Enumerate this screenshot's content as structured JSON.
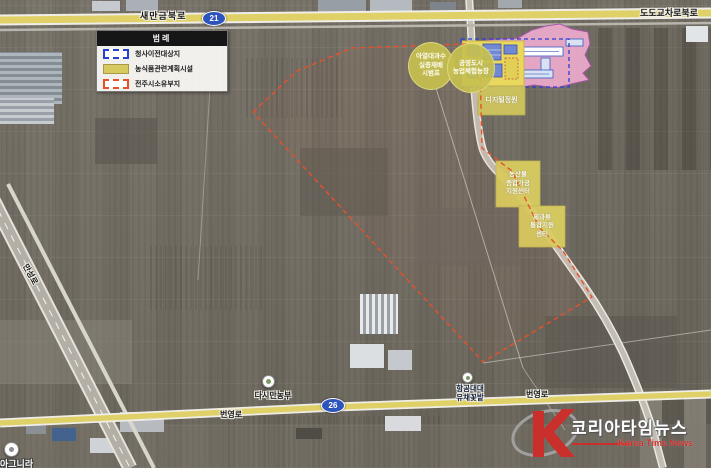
{
  "legend": {
    "title": "범례",
    "items": [
      {
        "label": "청사이전대상지",
        "swatch": "blue-dashed"
      },
      {
        "label": "농식품관련계획시설",
        "swatch": "yellow-fill"
      },
      {
        "label": "전주시소유부지",
        "swatch": "red-dashed"
      }
    ]
  },
  "roads": {
    "saemangeum": "새만금북로",
    "dodo_junction": "도도교차로북로",
    "byeongyeong_1": "번영로",
    "byeongyeong_2": "번영로",
    "manseong": "만성로",
    "route_21": "21",
    "route_26": "26"
  },
  "zones": {
    "circle_subtropical": {
      "lines": [
        "아열대과수",
        "실증재배",
        "시범포"
      ]
    },
    "circle_urban_farm": {
      "lines": [
        "공영도시",
        "농업체험농장"
      ]
    },
    "digital_garden": {
      "label": "디지털정원"
    },
    "agro_processing": {
      "lines": [
        "농산물",
        "종합가공",
        "지원센터"
      ]
    },
    "confectionery": {
      "lines": [
        "제과류",
        "통합지원",
        "센터"
      ]
    }
  },
  "pois": {
    "dasiman_farm": {
      "label": "다시만농부"
    },
    "aviation_field": {
      "lines": [
        "항공대대",
        "유채꽃밭"
      ]
    },
    "bottom_left": {
      "label": "아그니라"
    }
  },
  "watermark": {
    "korean": "코리아타임뉴스",
    "english": "Korea Time News"
  },
  "colors": {
    "road_yellow": "#e0d068",
    "route_badge_blue": "#2d54bc",
    "plan_yellow": "#d8cc60",
    "plan_pink": "#f2aed2",
    "legend_blue_dash": "#2840d0",
    "legend_red_dash": "#e8502a",
    "logo_red": "#c9302c"
  }
}
